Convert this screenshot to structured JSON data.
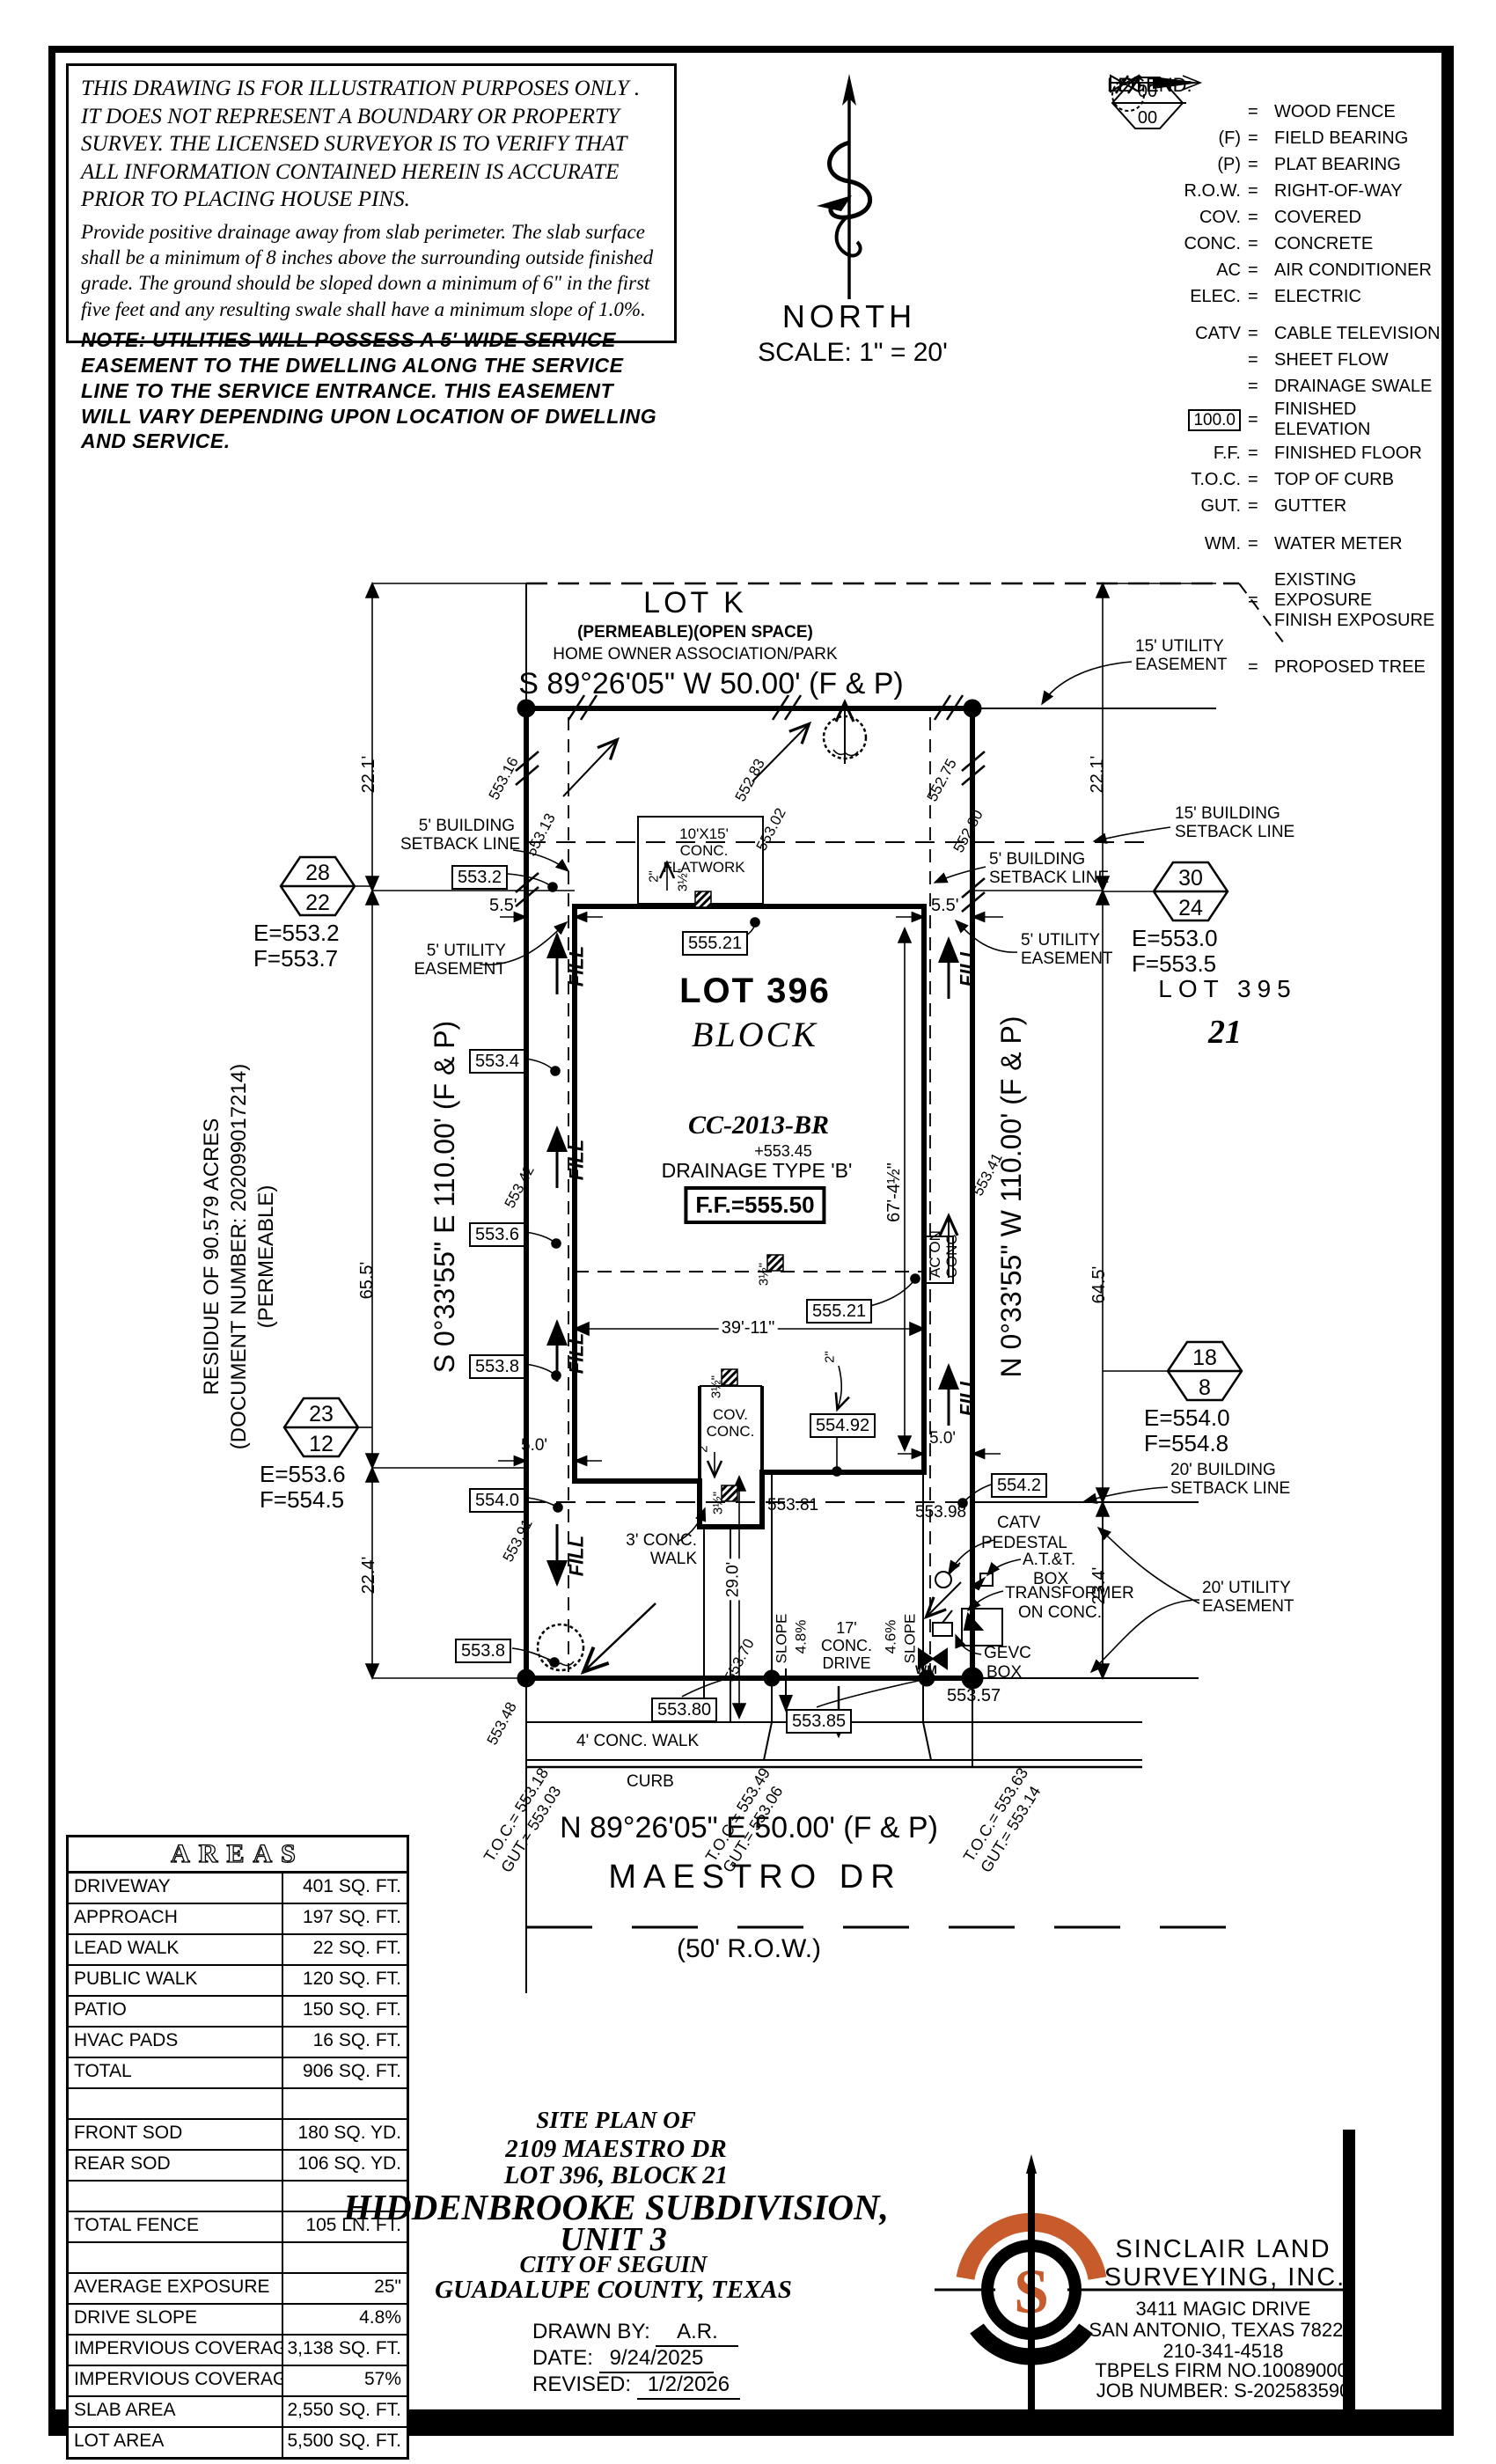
{
  "accent": "#C75B2C",
  "disclaimer": {
    "p1": "THIS DRAWING IS FOR ILLUSTRATION PURPOSES ONLY . IT DOES NOT REPRESENT A BOUNDARY OR PROPERTY SURVEY. THE LICENSED SURVEYOR IS TO VERIFY THAT ALL INFORMATION CONTAINED HEREIN IS ACCURATE PRIOR TO PLACING HOUSE PINS.",
    "p2": "Provide positive drainage away from slab perimeter. The slab surface shall be a minimum of 8 inches above the surrounding outside finished grade. The ground should be sloped down a minimum of 6\" in the first five feet and any resulting swale shall have a minimum slope of 1.0%.",
    "p3": "NOTE: UTILITIES WILL POSSESS A 5' WIDE SERVICE EASEMENT TO THE DWELLING ALONG THE SERVICE LINE TO THE SERVICE ENTRANCE. THIS EASEMENT WILL VARY DEPENDING UPON LOCATION OF DWELLING AND SERVICE."
  },
  "north": {
    "label": "NORTH",
    "scale": "SCALE:  1\" = 20'"
  },
  "legend": {
    "title": "LEGEND:",
    "eq": "=",
    "items": [
      {
        "sym": "",
        "label": "WOOD FENCE"
      },
      {
        "sym": "(F)",
        "label": "FIELD BEARING"
      },
      {
        "sym": "(P)",
        "label": "PLAT BEARING"
      },
      {
        "sym": "R.O.W.",
        "label": "RIGHT-OF-WAY"
      },
      {
        "sym": "COV.",
        "label": "COVERED"
      },
      {
        "sym": "CONC.",
        "label": "CONCRETE"
      },
      {
        "sym": "AC",
        "label": "AIR CONDITIONER"
      },
      {
        "sym": "ELEC.",
        "label": "ELECTRIC"
      },
      {
        "sym": "CATV",
        "label": "CABLE TELEVISION"
      },
      {
        "sym": "",
        "label": "SHEET FLOW"
      },
      {
        "sym": "",
        "label": "DRAINAGE SWALE"
      },
      {
        "sym": "100.0",
        "label": "FINISHED ELEVATION"
      },
      {
        "sym": "F.F.",
        "label": "FINISHED FLOOR"
      },
      {
        "sym": "T.O.C.",
        "label": "TOP OF CURB"
      },
      {
        "sym": "GUT.",
        "label": "GUTTER"
      },
      {
        "sym": "WM.",
        "label": "WATER METER"
      },
      {
        "sym": "00",
        "sym2": "00",
        "label": "EXISTING EXPOSURE",
        "label2": "FINISH EXPOSURE"
      },
      {
        "sym": "",
        "label": "PROPOSED TREE"
      }
    ]
  },
  "plat": {
    "lot_k": "LOT K",
    "lot_k_sub": "(PERMEABLE)(OPEN SPACE)",
    "lot_k_sub2": "HOME OWNER ASSOCIATION/PARK",
    "bearing_top": "S 89°26'05\" W  50.00'  (F & P)",
    "bearing_bottom": "N 89°26'05\" E  50.00'  (F & P)",
    "bearing_left": "S 0°33'55\" E  110.00'  (F & P)",
    "bearing_right": "N 0°33'55\" W  110.00'  (F & P)",
    "street": "MAESTRO DR",
    "row_label": "(50' R.O.W.)",
    "lot396": "LOT 396",
    "block": "BLOCK",
    "cc": "CC-2013-BR",
    "spot_cc": "+553.45",
    "drainage": "DRAINAGE TYPE 'B'",
    "ff": "F.F.=555.50",
    "lot395": "LOT 395",
    "block21": "21",
    "residue1": "RESIDUE OF 90.579 ACRES",
    "residue2": "(DOCUMENT NUMBER: 202099017214)",
    "residue3": "(PERMEABLE)",
    "hex": [
      {
        "t": "28",
        "b": "22",
        "e": "E=553.2",
        "f": "F=553.7"
      },
      {
        "t": "30",
        "b": "24",
        "e": "E=553.0",
        "f": "F=553.5"
      },
      {
        "t": "23",
        "b": "12",
        "e": "E=553.6",
        "f": "F=554.5"
      },
      {
        "t": "18",
        "b": "8",
        "e": "E=554.0",
        "f": "F=554.8"
      }
    ],
    "dims": {
      "left_top": "22.1'",
      "right_top": "22.1'",
      "left_mid": "65.5'",
      "right_mid": "64.5'",
      "left_bot": "22.4'",
      "right_bot": "23.4'",
      "house_w": "39'-11\"",
      "house_d": "67'-4½\"",
      "sb_l": "5.5'",
      "sb_r": "5.5'",
      "gap_l": "5.0'",
      "gap_r": "5.0'",
      "drive_len": "29.0'"
    },
    "callouts": {
      "bsl5": "5' BUILDING",
      "bsl5b": "SETBACK LINE",
      "ue5": "5' UTILITY",
      "ue5b": "EASEMENT",
      "bsl15": "15' BUILDING",
      "bsl15b": "SETBACK LINE",
      "ue15": "15' UTILITY",
      "ue15b": "EASEMENT",
      "bsl20": "20' BUILDING",
      "bsl20b": "SETBACK LINE",
      "ue20": "20' UTILITY",
      "ue20b": "EASEMENT",
      "flat1": "10'X15'",
      "flat2": "CONC.",
      "flat3": "FLATWORK",
      "cov1": "COV.",
      "cov2": "CONC.",
      "walk3a": "3' CONC.",
      "walk3b": "WALK",
      "walk4": "4' CONC. WALK",
      "curb": "CURB",
      "drive1": "17'",
      "drive2": "CONC.",
      "drive3": "DRIVE",
      "slope": "SLOPE",
      "slope_lv": "4.8%",
      "slope_rv": "4.6%",
      "ac1": "AC ON",
      "ac2": "CONC.",
      "catv1": "CATV",
      "catv2": "PEDESTAL",
      "att1": "A.T.&T.",
      "att2": "BOX",
      "tx1": "TRANSFORMER",
      "tx2": "ON CONC.",
      "gevc1": "GEVC",
      "gevc2": "BOX",
      "wm": "WM",
      "fill": "FILL",
      "m35": "3½\"",
      "m2": "2\""
    },
    "boxes": {
      "b5532": "553.2",
      "b5534": "553.4",
      "b5536": "553.6",
      "b5538": "553.8",
      "b5540": "554.0",
      "b5538b": "553.8",
      "b55521a": "555.21",
      "b55521b": "555.21",
      "b55492": "554.92",
      "b5542": "554.2",
      "b55380": "553.80",
      "b55385": "553.85"
    },
    "spots": {
      "s1": "553.16",
      "s2": "553.13",
      "s3": "552.83",
      "s4": "553.02",
      "s5": "552.75",
      "s6": "552.80",
      "s7": "553.42",
      "s8": "553.41",
      "s9": "553.91",
      "s10": "553.70",
      "s11": "553.48",
      "s12": "553.81",
      "s13": "553.98",
      "s14": "553.57"
    },
    "toc": [
      {
        "t": "T.O.C.= 553.18",
        "g": "GUT.= 553.03"
      },
      {
        "t": "T.O.C.= 553.49",
        "g": "GUT.= 553.06"
      },
      {
        "t": "T.O.C.= 553.63",
        "g": "GUT.= 553.14"
      }
    ]
  },
  "areas": {
    "title": "AREAS",
    "rows": [
      {
        "label": "DRIVEWAY",
        "value": "401 SQ. FT."
      },
      {
        "label": "APPROACH",
        "value": "197 SQ. FT."
      },
      {
        "label": "LEAD WALK",
        "value": "22 SQ. FT."
      },
      {
        "label": "PUBLIC WALK",
        "value": "120 SQ. FT."
      },
      {
        "label": "PATIO",
        "value": "150 SQ. FT."
      },
      {
        "label": "HVAC PADS",
        "value": "16 SQ. FT."
      },
      {
        "label": "TOTAL",
        "value": "906 SQ. FT."
      },
      {
        "label": "",
        "value": ""
      },
      {
        "label": "FRONT SOD",
        "value": "180 SQ. YD."
      },
      {
        "label": "REAR SOD",
        "value": "106 SQ. YD."
      },
      {
        "label": "",
        "value": ""
      },
      {
        "label": "TOTAL FENCE",
        "value": "105  LN. FT."
      },
      {
        "label": "",
        "value": ""
      },
      {
        "label": "AVERAGE EXPOSURE",
        "value": "25\""
      },
      {
        "label": "DRIVE SLOPE",
        "value": "4.8%"
      },
      {
        "label": "IMPERVIOUS COVERAGE",
        "value": "3,138 SQ. FT."
      },
      {
        "label": "IMPERVIOUS COVERAGE %",
        "value": "57%"
      },
      {
        "label": "SLAB AREA",
        "value": "2,550 SQ. FT."
      },
      {
        "label": "LOT AREA",
        "value": "5,500 SQ. FT."
      }
    ]
  },
  "titleblock": {
    "l1": "SITE PLAN OF",
    "l2": "2109 MAESTRO DR",
    "l3": "LOT 396, BLOCK 21",
    "l4": "HIDDENBROOKE SUBDIVISION,",
    "l5": "UNIT 3",
    "l6": "CITY OF SEGUIN",
    "l7": "GUADALUPE COUNTY, TEXAS",
    "drawn_label": "DRAWN BY:",
    "drawn": "A.R.",
    "date_label": "DATE:",
    "date": "9/24/2025",
    "rev_label": "REVISED:",
    "revised": "1/2/2026"
  },
  "surveyor": {
    "logo_letter": "S",
    "name1": "SINCLAIR LAND",
    "name2": "SURVEYING, INC.",
    "addr1": "3411 MAGIC DRIVE",
    "addr2": "SAN ANTONIO, TEXAS 78229",
    "phone": "210-341-4518",
    "firm": "TBPELS FIRM NO.10089000",
    "job": "JOB NUMBER: S-202583590"
  }
}
